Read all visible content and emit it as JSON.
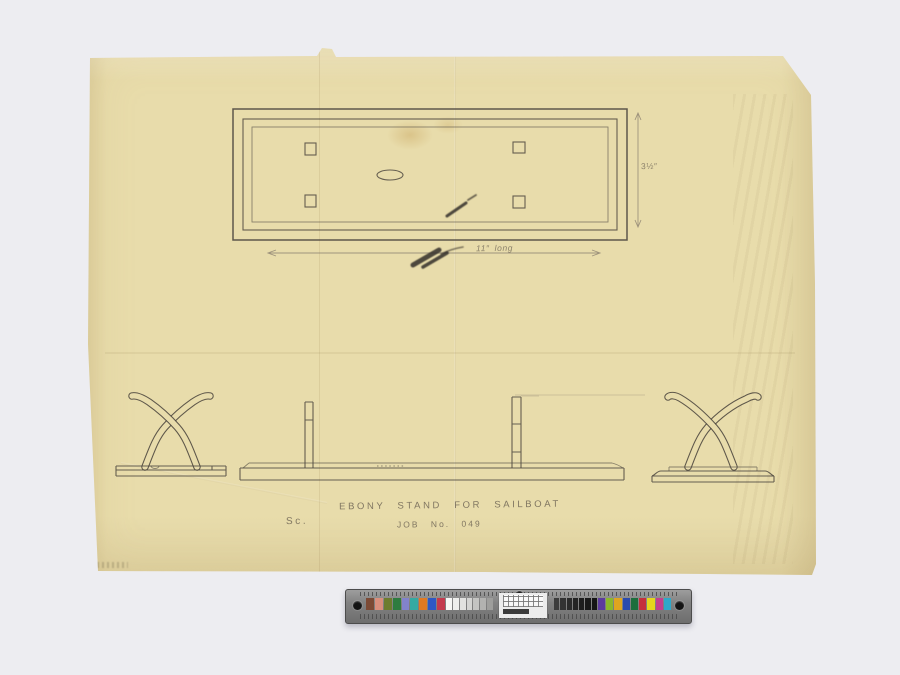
{
  "annotations": {
    "title": "EBONY STAND FOR SAILBOAT",
    "scale_note": "Sc.",
    "job_note": "JOB No. 049",
    "width_dim": "3½″",
    "length_dim": "11″ long"
  },
  "colors": {
    "backdrop": "#ededf1",
    "paper": "#e8dcab",
    "pencil": "#4e4840",
    "pencil_faint": "#857b6c",
    "ruler_body": "#8f8f8f"
  },
  "color_bar": {
    "left_patches": [
      "#7c4a35",
      "#d98f7d",
      "#6d7c2e",
      "#2e7c3f",
      "#8283cc",
      "#35aaa2",
      "#e07a22",
      "#2f58c4",
      "#c43b4e"
    ],
    "gray_ramp": [
      "#f7f7f5",
      "#eeeeec",
      "#e2e2e0",
      "#d4d4d2",
      "#c4c4c2",
      "#b2b2b0",
      "#9e9e9c"
    ],
    "dark_ramp": [
      "#3c3c3c",
      "#333333",
      "#2b2b2b",
      "#242424",
      "#1e1e1e",
      "#191919",
      "#151515"
    ],
    "right_patches": [
      "#5c3b9e",
      "#8cb82c",
      "#e0a51f",
      "#2c4bad",
      "#1d6e3c",
      "#c52f3d",
      "#e6d51d",
      "#c43f8e",
      "#2fa8c9"
    ]
  }
}
